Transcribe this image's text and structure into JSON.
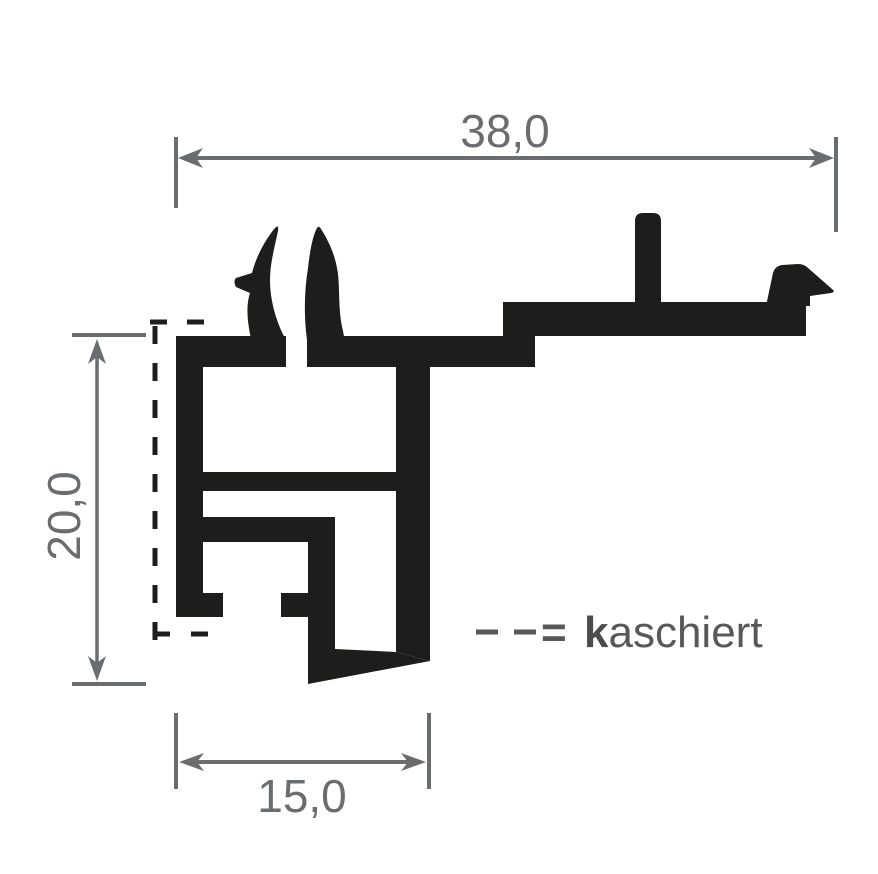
{
  "page": {
    "background": "#ffffff"
  },
  "drawing": {
    "type": "aluminium-profile-cross-section",
    "colors": {
      "profile": "#1d1d1b",
      "dimension": "#6a6d70",
      "legend_text": "#58585a"
    },
    "dimension_labels": {
      "top_width": "38,0",
      "left_height": "20,0",
      "bottom_width": "15,0"
    },
    "measurements_mm": {
      "overall_width": 38.0,
      "overall_height": 20.0,
      "bottom_width": 15.0
    },
    "legend": {
      "dash_symbol": "- -",
      "equals_sign": "=",
      "term_bold_prefix": "k",
      "term_rest": "aschiert",
      "term_full": "kaschiert"
    }
  }
}
